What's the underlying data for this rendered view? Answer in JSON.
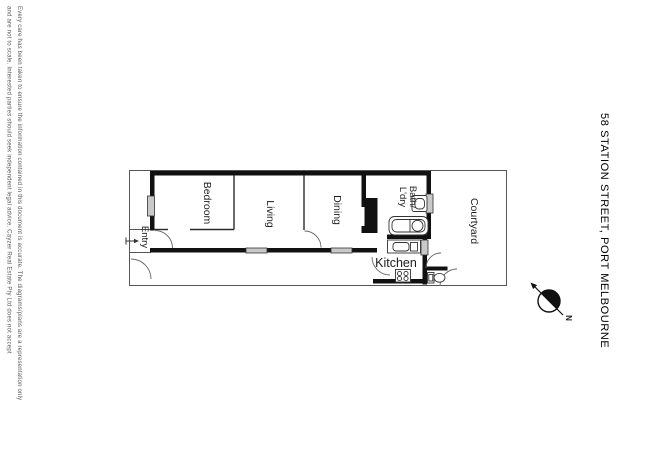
{
  "title": {
    "text": "58 STATION STREET, PORT MELBOURNE"
  },
  "disclaimer": {
    "line1": "Every care has been taken to ensure the information contained in this document is accurate. The diagrams/plans are a representation only",
    "line2": "and are not to scale. Interested parties should seek independent legal advice. Cayzer Real Estate Pty Ltd does not accept"
  },
  "floor_plan": {
    "rooms": {
      "entry": "Entry",
      "bedroom": "Bedroom",
      "living": "Living",
      "dining": "Dining",
      "bath_line1": "Bath/",
      "bath_line2": "L'dry",
      "kitchen": "Kitchen",
      "courtyard": "Courtyard"
    }
  },
  "compass": {
    "north_label": "N"
  },
  "colors": {
    "wall": "#111111",
    "window_fill": "#c9c9c9",
    "notch": "#ffffff",
    "compass_fill": "#111111"
  }
}
